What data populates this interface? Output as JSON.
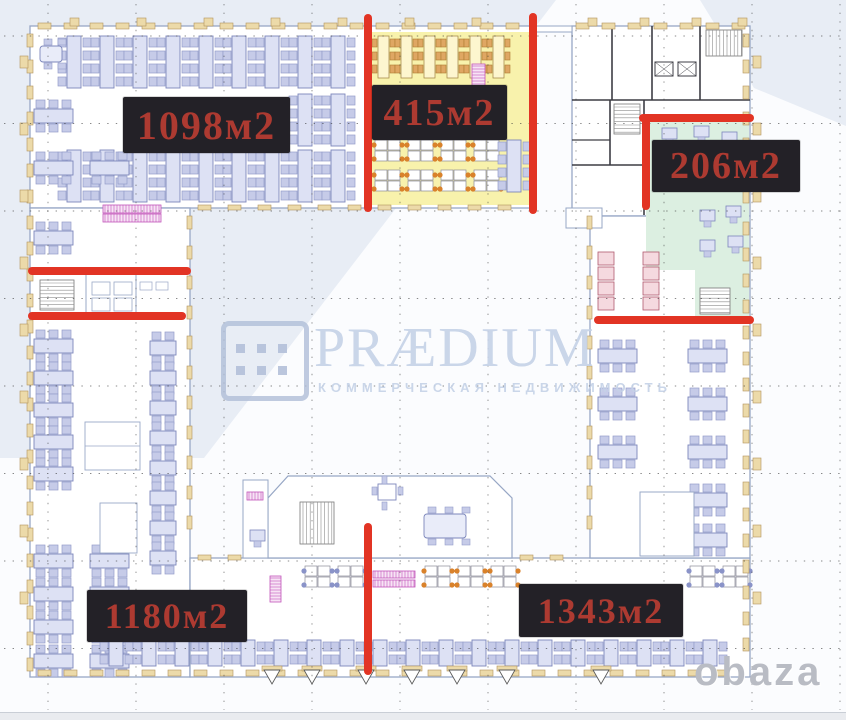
{
  "watermark": {
    "brand": "PRÆDIUM",
    "subtitle": "КОММЕРЧЕСКАЯ НЕДВИЖИМОСТЬ",
    "color": "#c5d2e7"
  },
  "photo_credit": {
    "text": "obaza",
    "color": "#b9bcc4"
  },
  "area_labels": [
    {
      "id": "area-1098",
      "text": "1098м2"
    },
    {
      "id": "area-415",
      "text": "415м2"
    },
    {
      "id": "area-206",
      "text": "206м2"
    },
    {
      "id": "area-1180",
      "text": "1180м2"
    },
    {
      "id": "area-1343",
      "text": "1343м2"
    }
  ],
  "label_style": {
    "background": "#232127",
    "text_color": "#ad3a31"
  },
  "colors": {
    "divider_red": "#e23424",
    "area_415_fill": "#f8f2ac",
    "area_206_fill": "#dcefe1",
    "background_tint": "#e8edf5"
  }
}
